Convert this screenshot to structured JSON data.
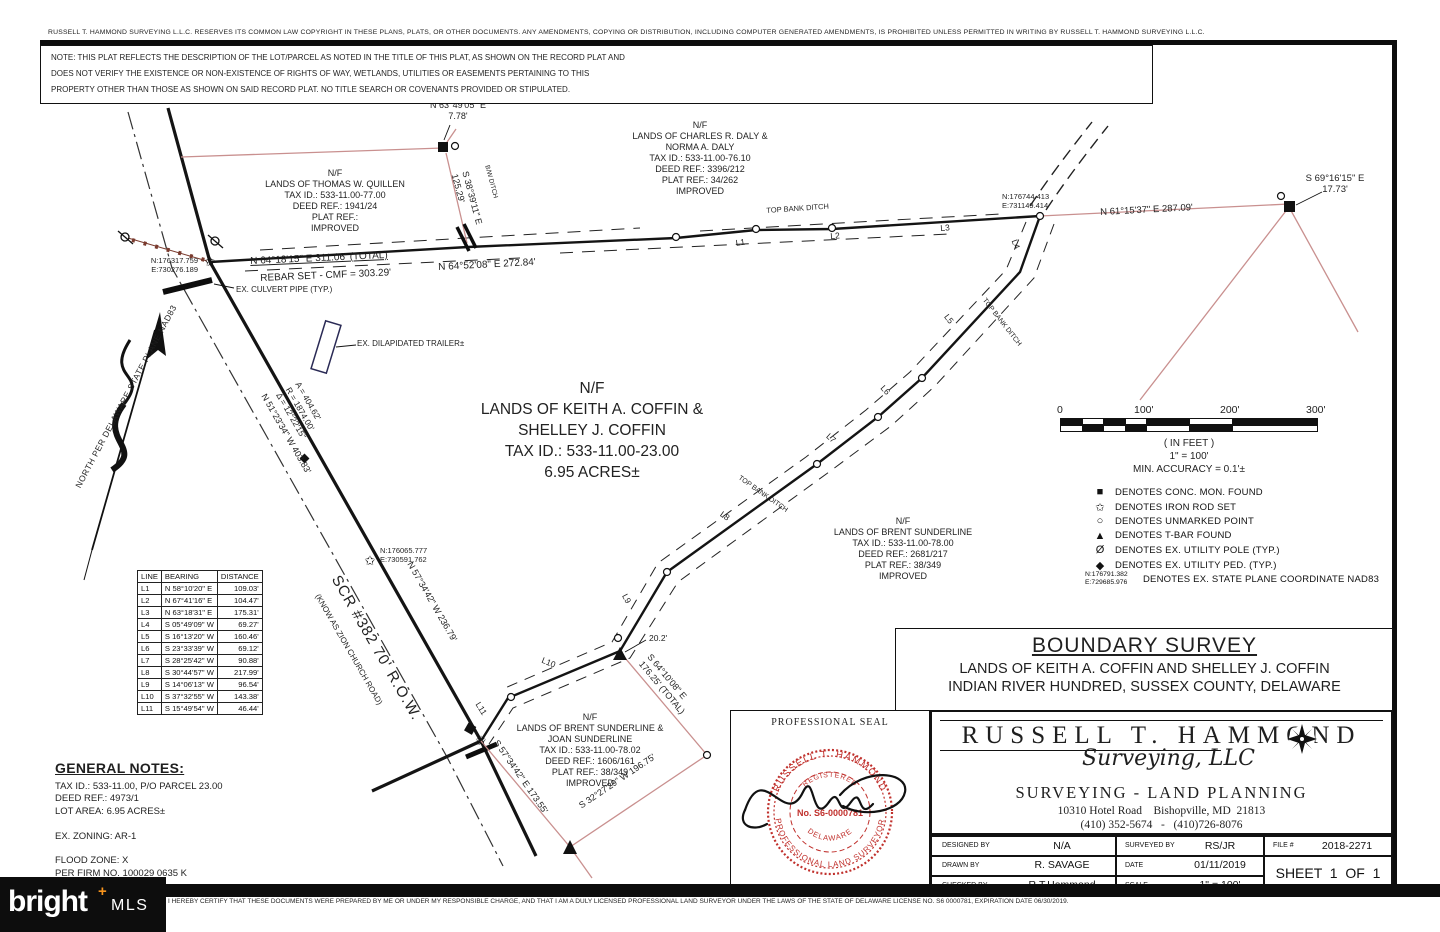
{
  "page": {
    "copyright": "RUSSELL T. HAMMOND SURVEYING L.L.C. RESERVES ITS COMMON LAW COPYRIGHT IN THESE PLANS, PLATS, OR OTHER DOCUMENTS. ANY AMENDMENTS, COPYING OR DISTRIBUTION, INCLUDING COMPUTER GENERATED AMENDMENTS, IS PROHIBITED UNLESS PERMITTED IN WRITING BY RUSSELL T. HAMMOND SURVEYING L.L.C.",
    "note": "NOTE: THIS PLAT REFLECTS THE DESCRIPTION OF THE LOT/PARCEL AS NOTED IN THE TITLE OF THIS PLAT, AS SHOWN ON THE RECORD PLAT AND\nDOES NOT VERIFY THE EXISTENCE OR NON-EXISTENCE OF RIGHTS OF WAY, WETLANDS, UTILITIES OR EASEMENTS PERTAINING TO THIS\nPROPERTY OTHER THAN THOSE AS SHOWN ON SAID RECORD PLAT. NO TITLE SEARCH OR COVENANTS PROVIDED OR STIPULATED."
  },
  "parcels": {
    "quillen": "N/F\nLANDS OF THOMAS W. QUILLEN\nTAX ID.: 533-11.00-77.00\nDEED REF.: 1941/24\nPLAT REF.:\nIMPROVED",
    "daly": "N/F\nLANDS OF CHARLES R. DALY &\nNORMA A. DALY\nTAX ID.: 533-11.00-76.10\nDEED REF.: 3396/212\nPLAT REF.: 34/262\nIMPROVED",
    "coffin": "N/F\nLANDS OF KEITH A. COFFIN &\nSHELLEY J. COFFIN\nTAX ID.: 533-11.00-23.00\n6.95 ACRES±",
    "sunderline_brent": "N/F\nLANDS OF BRENT SUNDERLINE\nTAX ID.: 533-11.00-78.00\nDEED REF.: 2681/217\nPLAT REF.: 38/349\nIMPROVED",
    "sunderline_joan": "N/F\nLANDS OF BRENT SUNDERLINE &\nJOAN SUNDERLINE\nTAX ID.: 533-11.00-78.02\nDEED REF.: 1606/161\nPLAT REF.: 38/349\nIMPROVED"
  },
  "labels": {
    "n63_49": "N 63°49'05\" E\n7.78'",
    "s38_39": "S 38°39'11\" E\n125.29'",
    "bw_ditch": "B/W DITCH",
    "n64_18": "N 64°18'15\" E  311.06' (TOTAL)",
    "rebar": "REBAR SET - CMF = 303.29'",
    "n64_52": "N 64°52'08\" E  272.84'",
    "top_bank_ditch": "TOP BANK DITCH",
    "n61_15": "N 61°15'37\" E  287.09'",
    "s69_16": "S 69°16'15\" E\n17.73'",
    "n51_23": "N 51°23'34\" W  403.83'",
    "curve": "A = 404.62'\nR = 1874.00'\nΔ = 12°22'15\"",
    "n57_34": "N 57°34'42\" W  236.79'",
    "scr_road": "SCR #382  70' R.O.W.",
    "zion": "(KNOW AS ZION CHURCH ROAD)",
    "s57_34": "S 57°34'42\" E  173.55'",
    "s32_27": "S 32°27'29\" W  196.75'",
    "s64_10": "S 64°10'08\" E\n176.25' (TOTAL)",
    "dim20": "20.2'",
    "culvert": "EX. CULVERT PIPE (TYP.)",
    "trailer": "EX. DILAPIDATED TRAILER±",
    "north": "NORTH PER DELAWARE STATE PLANE NAD83"
  },
  "coords": {
    "nw": "N:176317.759\nE:730276.189",
    "ne": "N:176744.413\nE:731149.414",
    "road": "N:176065.777\nE:730591.762"
  },
  "segments": [
    "L1",
    "L2",
    "L3",
    "L4",
    "L5",
    "L6",
    "L7",
    "L8",
    "L9",
    "L10",
    "L11"
  ],
  "line_table": {
    "headers": [
      "LINE",
      "BEARING",
      "DISTANCE"
    ],
    "rows": [
      {
        "id": "L1",
        "bearing": "N 58°10'20\" E",
        "distance": "109.03'"
      },
      {
        "id": "L2",
        "bearing": "N 67°41'16\" E",
        "distance": "104.47'"
      },
      {
        "id": "L3",
        "bearing": "N 63°18'31\" E",
        "distance": "175.31'"
      },
      {
        "id": "L4",
        "bearing": "S 05°49'09\" W",
        "distance": "69.27'"
      },
      {
        "id": "L5",
        "bearing": "S 16°13'20\" W",
        "distance": "160.46'"
      },
      {
        "id": "L6",
        "bearing": "S 23°33'39\" W",
        "distance": "69.12'"
      },
      {
        "id": "L7",
        "bearing": "S 28°25'42\" W",
        "distance": "90.88'"
      },
      {
        "id": "L8",
        "bearing": "S 30°44'57\" W",
        "distance": "217.99'"
      },
      {
        "id": "L9",
        "bearing": "S 14°06'13\" W",
        "distance": "96.54'"
      },
      {
        "id": "L10",
        "bearing": "S 37°32'55\" W",
        "distance": "143.38'"
      },
      {
        "id": "L11",
        "bearing": "S 15°49'54\" W",
        "distance": "46.44'"
      }
    ]
  },
  "scale_bar": {
    "ticks": [
      "0",
      "100'",
      "200'",
      "300'"
    ],
    "in_feet": "( IN FEET )",
    "ratio": "1\" = 100'",
    "accuracy": "MIN. ACCURACY = 0.1'±"
  },
  "legend": {
    "items": [
      {
        "symbol": "■",
        "text": "DENOTES CONC. MON. FOUND"
      },
      {
        "symbol": "✩",
        "text": "DENOTES IRON ROD SET"
      },
      {
        "symbol": "○",
        "text": "DENOTES UNMARKED POINT"
      },
      {
        "symbol": "▲",
        "text": "DENOTES T-BAR FOUND"
      },
      {
        "symbol": "Ø",
        "text": "DENOTES EX. UTILITY POLE (TYP.)"
      },
      {
        "symbol": "◆",
        "text": "DENOTES EX. UTILITY PED. (TYP.)"
      },
      {
        "symbol": "N:176791.382\nE:729685.976",
        "text": "DENOTES EX. STATE PLANE COORDINATE NAD83"
      }
    ]
  },
  "general_notes": {
    "title": "GENERAL NOTES:",
    "body": "TAX ID.: 533-11.00, P/O PARCEL 23.00\nDEED REF.: 4973/1\nLOT AREA: 6.95 ACRES±\n\nEX. ZONING: AR-1\n\nFLOOD ZONE: X\nPER FIRM NO. 100029 0635 K\nDATED MARCH 16, 2015."
  },
  "title": {
    "main": "BOUNDARY SURVEY",
    "line2": "LANDS OF KEITH A. COFFIN AND SHELLEY J. COFFIN",
    "line3": "INDIAN RIVER HUNDRED, SUSSEX COUNTY, DELAWARE"
  },
  "firm": {
    "name": "RUSSELL T. HAMMOND",
    "script": "Surveying, LLC",
    "tagline": "SURVEYING - LAND PLANNING",
    "address": "10310 Hotel Road    Bishopville, MD  21813",
    "phones": "(410) 352-5674   -   (410)726-8076"
  },
  "seal": {
    "header": "PROFESSIONAL SEAL",
    "ring_top": "RUSSELL T. HAMMOND",
    "ring_bottom": "PROFESSIONAL LAND SURVEYOR",
    "registered": "REGISTERED",
    "number": "No. S6-0000781",
    "state": "DELAWARE"
  },
  "titleblock": {
    "designed_label": "DESIGNED BY",
    "designed_value": "N/A",
    "surveyed_label": "SURVEYED BY",
    "surveyed_value": "RS/JR",
    "file_label": "FILE #",
    "file_value": "2018-2271",
    "drawn_label": "DRAWN BY",
    "drawn_value": "R. SAVAGE",
    "date_label": "DATE",
    "date_value": "01/11/2019",
    "checked_label": "CHECKED BY",
    "checked_value": "R.T.Hammond",
    "scale_label": "SCALE",
    "scale_value": "1\" = 100'",
    "sheet": "SHEET  1  OF  1"
  },
  "footer": {
    "certification": "I HEREBY CERTIFY THAT THESE DOCUMENTS WERE PREPARED BY ME OR UNDER MY RESPONSIBLE CHARGE, AND THAT I AM A DULY LICENSED PROFESSIONAL LAND SURVEYOR UNDER THE LAWS OF THE STATE OF DELAWARE LICENSE NO. S6 0000781, EXPIRATION DATE 06/30/2019.",
    "logo_text": "bright",
    "logo_plus": "+",
    "logo_sub": "MLS"
  },
  "colors": {
    "boundary_pink": "#c9908f",
    "seal_red": "#c0302c",
    "logo_orange": "#f7941d",
    "ink": "#1b1b1b"
  }
}
